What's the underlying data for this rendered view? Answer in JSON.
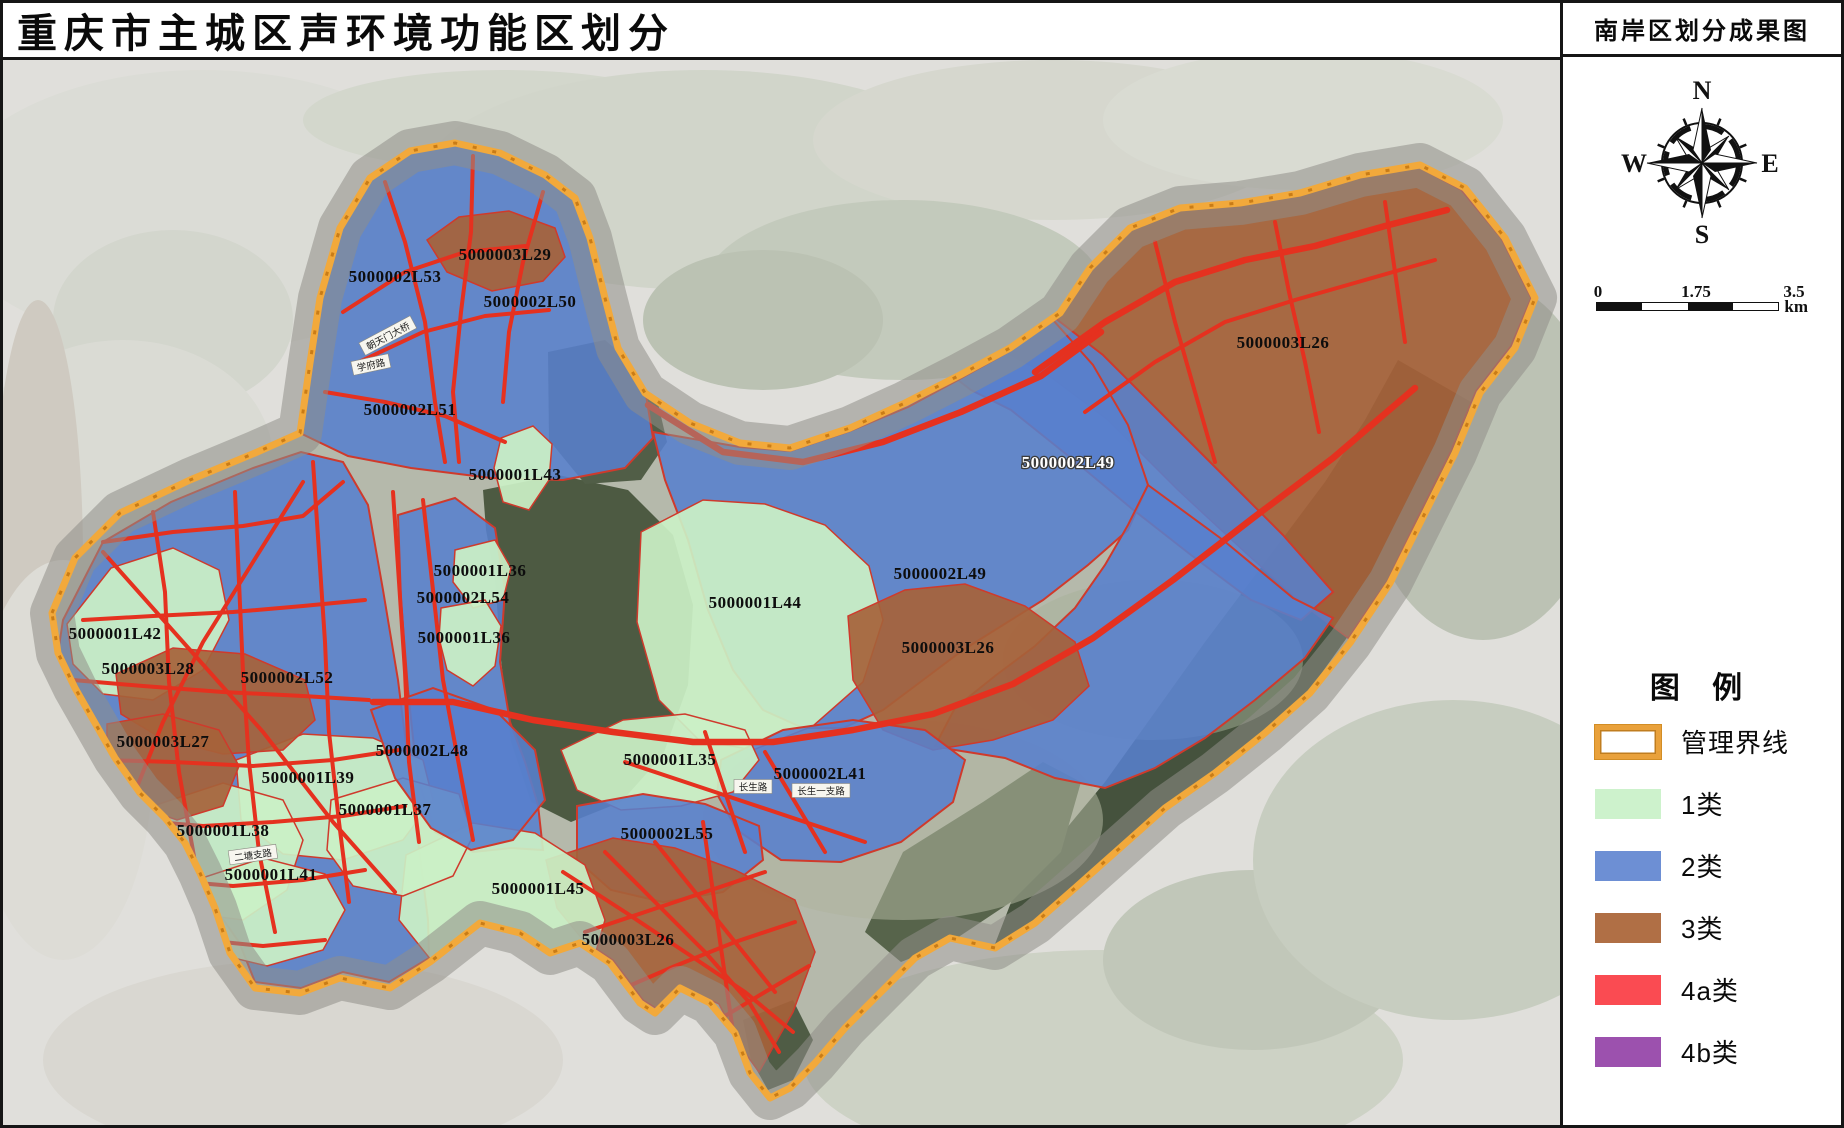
{
  "title": "重庆市主城区声环境功能区划分",
  "panel": {
    "title": "南岸区划分成果图",
    "compass": {
      "n": "N",
      "e": "E",
      "s": "S",
      "w": "W"
    },
    "scale": {
      "start": "0",
      "mid": "1.75",
      "end": "3.5",
      "unit": "km"
    },
    "legend": {
      "heading": "图 例",
      "boundary": {
        "label": "管理界线",
        "color": "#E9A13B"
      },
      "items": [
        {
          "label": "1类",
          "color": "#CDF2CC"
        },
        {
          "label": "2类",
          "color": "#6D8FD4"
        },
        {
          "label": "3类",
          "color": "#B06F45"
        },
        {
          "label": "4a类",
          "color": "#FA4B52"
        },
        {
          "label": "4b类",
          "color": "#9C51AE"
        }
      ]
    }
  },
  "map": {
    "zone_labels": [
      {
        "text": "5000003L29",
        "x": 502,
        "y": 200
      },
      {
        "text": "5000002L53",
        "x": 392,
        "y": 222
      },
      {
        "text": "5000002L50",
        "x": 527,
        "y": 247
      },
      {
        "text": "5000002L51",
        "x": 407,
        "y": 355
      },
      {
        "text": "5000001L43",
        "x": 512,
        "y": 420
      },
      {
        "text": "5000003L26",
        "x": 1280,
        "y": 288
      },
      {
        "text": "5000002L49",
        "x": 1065,
        "y": 408,
        "white": true
      },
      {
        "text": "5000002L49",
        "x": 937,
        "y": 519
      },
      {
        "text": "5000001L44",
        "x": 752,
        "y": 548
      },
      {
        "text": "5000003L26",
        "x": 945,
        "y": 593
      },
      {
        "text": "5000001L42",
        "x": 112,
        "y": 579
      },
      {
        "text": "5000003L28",
        "x": 145,
        "y": 614
      },
      {
        "text": "5000002L52",
        "x": 284,
        "y": 623
      },
      {
        "text": "5000003L27",
        "x": 160,
        "y": 687
      },
      {
        "text": "5000002L48",
        "x": 419,
        "y": 696
      },
      {
        "text": "5000001L39",
        "x": 305,
        "y": 723
      },
      {
        "text": "5000001L37",
        "x": 382,
        "y": 755
      },
      {
        "text": "5000001L38",
        "x": 220,
        "y": 776
      },
      {
        "text": "5000001L41",
        "x": 268,
        "y": 820
      },
      {
        "text": "5000001L35",
        "x": 667,
        "y": 705
      },
      {
        "text": "5000002L41",
        "x": 817,
        "y": 719
      },
      {
        "text": "5000002L55",
        "x": 664,
        "y": 779
      },
      {
        "text": "5000001L45",
        "x": 535,
        "y": 834
      },
      {
        "text": "5000003L26",
        "x": 625,
        "y": 885
      },
      {
        "text": "5000001L36",
        "x": 477,
        "y": 516
      },
      {
        "text": "5000002L54",
        "x": 460,
        "y": 543
      },
      {
        "text": "5000001L36",
        "x": 461,
        "y": 583
      }
    ],
    "road_labels": [
      {
        "text": "朝天门大桥",
        "x": 385,
        "y": 276,
        "rot": -28
      },
      {
        "text": "学府路",
        "x": 368,
        "y": 305,
        "rot": -12
      },
      {
        "text": "二塘支路",
        "x": 250,
        "y": 795,
        "rot": -8
      },
      {
        "text": "长生路",
        "x": 750,
        "y": 727,
        "rot": 0
      },
      {
        "text": "长生一支路",
        "x": 818,
        "y": 731,
        "rot": 0
      }
    ]
  }
}
